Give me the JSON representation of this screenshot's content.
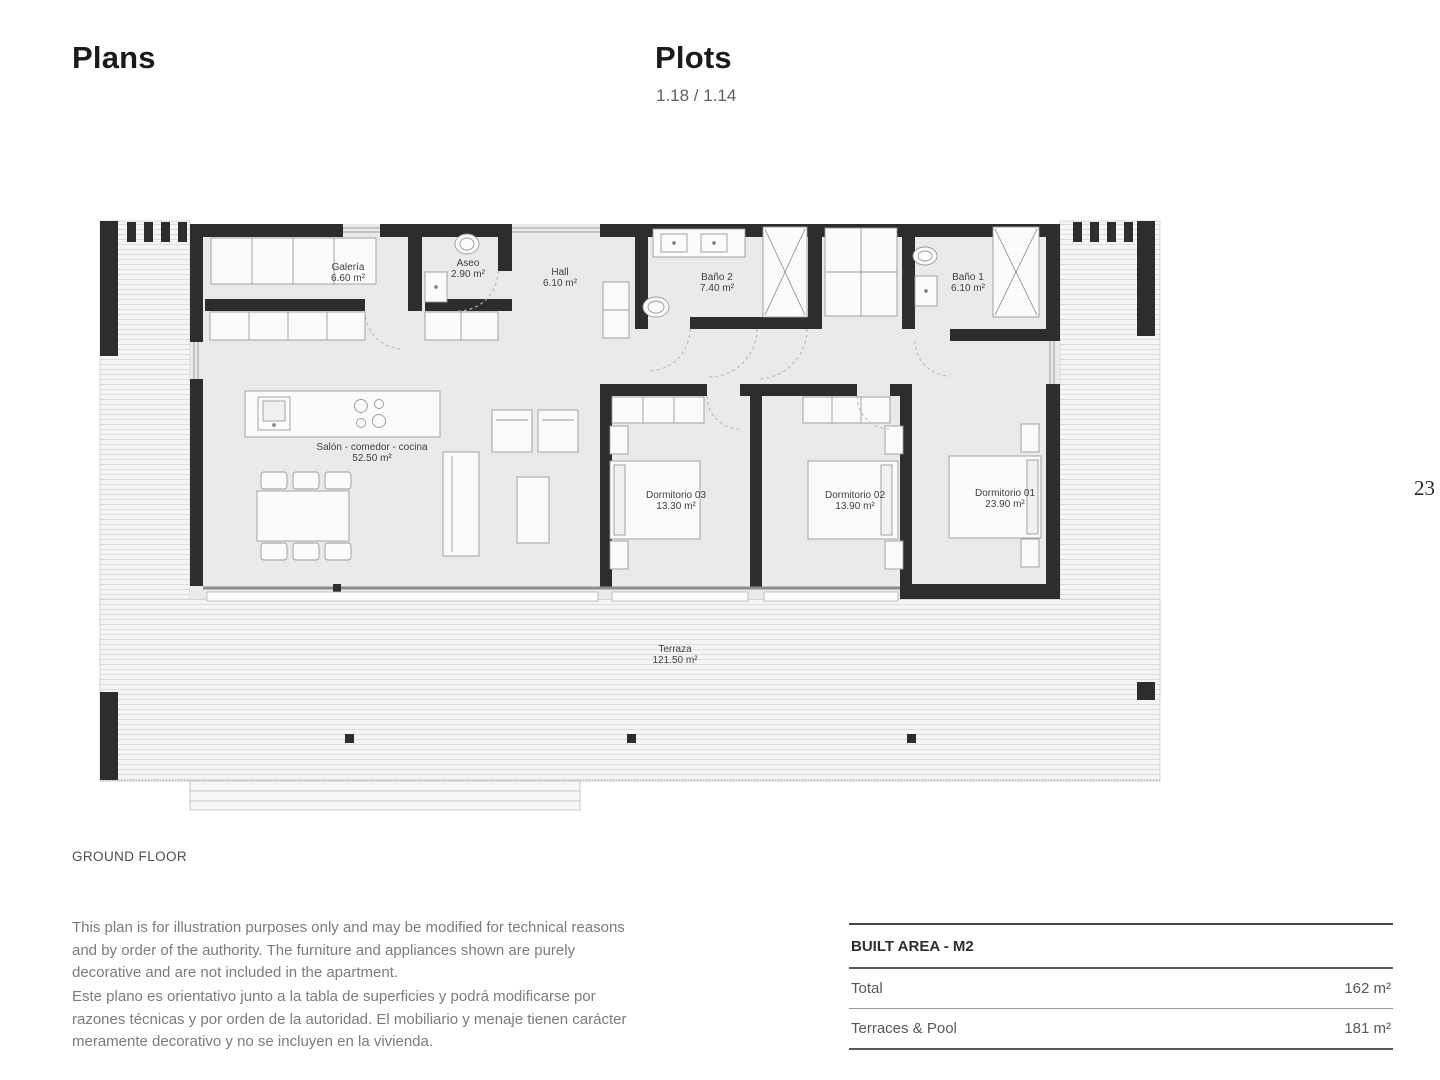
{
  "header": {
    "left_title": "Plans",
    "right_title": "Plots",
    "right_subtitle": "1.18 / 1.14"
  },
  "page_number": "23",
  "floor_label": "GROUND FLOOR",
  "disclaimers": {
    "en": "This plan is for illustration purposes only and may be modified for technical reasons and by order of the authority. The furniture and appliances shown are purely decorative and are not included in the apartment.",
    "es": "Este plano es orientativo junto a la tabla de superficies y podrá modificarse por razones técnicas y por orden de la autoridad. El mobiliario y menaje tienen carácter meramente decorativo y no se incluyen en la vivienda."
  },
  "floorplan": {
    "rooms": [
      {
        "name": "Galería",
        "area": "6.60 m²"
      },
      {
        "name": "Aseo",
        "area": "2.90 m²"
      },
      {
        "name": "Hall",
        "area": "6.10 m²"
      },
      {
        "name": "Baño 2",
        "area": "7.40 m²"
      },
      {
        "name": "Baño 1",
        "area": "6.10 m²"
      },
      {
        "name": "Salón - comedor - cocina",
        "area": "52.50 m²"
      },
      {
        "name": "Dormitorio 03",
        "area": "13.30 m²"
      },
      {
        "name": "Dormitorio 02",
        "area": "13.90 m²"
      },
      {
        "name": "Dormitorio 01",
        "area": "23.90 m²"
      },
      {
        "name": "Terraza",
        "area": "121.50 m²"
      }
    ]
  },
  "built_area_table": {
    "header": "BUILT AREA - M2",
    "rows": [
      {
        "label": "Total",
        "value": "162 m²"
      },
      {
        "label": "Terraces & Pool",
        "value": "181 m²"
      }
    ]
  },
  "colors": {
    "wall": "#2d2d2d",
    "interior": "#eaeaea",
    "deck_stripe": "#dcdcdc",
    "text": "#3f3f3f"
  }
}
